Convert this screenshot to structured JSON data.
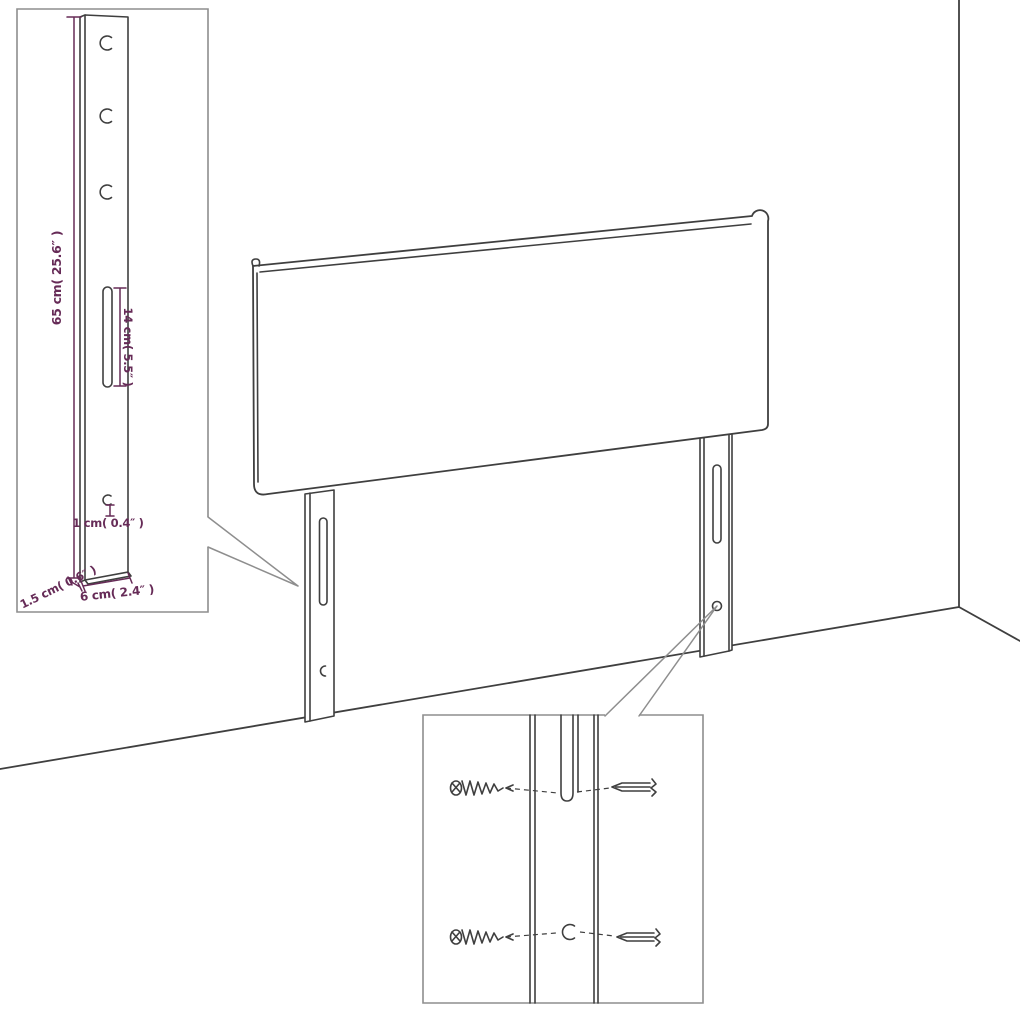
{
  "page": {
    "background_color": "#ffffff"
  },
  "diagram": {
    "kind": "headboard-assembly-dimension-diagram",
    "colors": {
      "outline": "#3f3f3f",
      "detail_box_border": "#8e8e8e",
      "dimension_accent": "#662b57"
    },
    "leg_detail_inset": {
      "dimension_labels": {
        "total_height": "65 cm( 25.6″ )",
        "slot_length": "14 cm( 5.5″ )",
        "hole_size": "1 cm( 0.4″ )",
        "side_thickness": "1.5 cm( 0.6″ )",
        "front_width": "6 cm( 2.4″ )"
      },
      "hole_count": 4,
      "slot_count": 1
    },
    "hardware_detail_inset": {
      "wood_screw_count": 2,
      "bolt_count": 2
    }
  }
}
